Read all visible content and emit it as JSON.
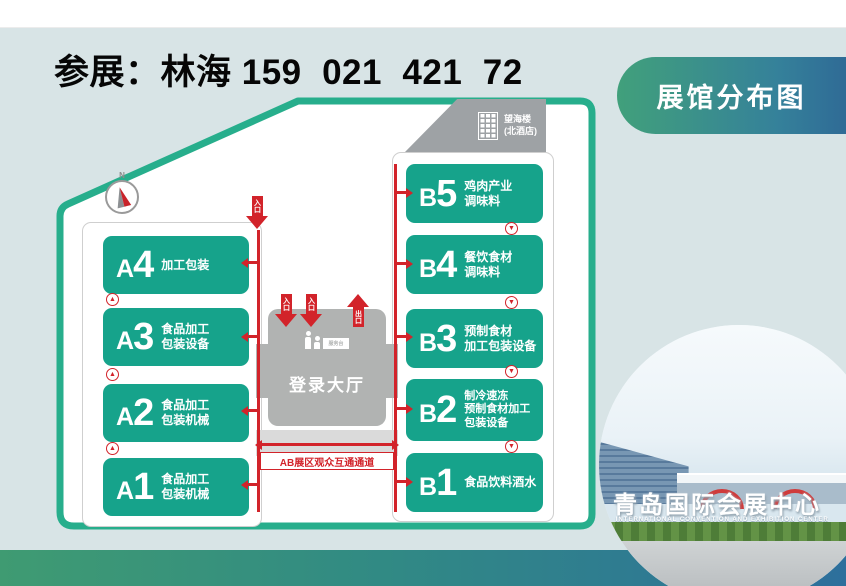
{
  "page": {
    "title": "参展：林海 159  021  421  72"
  },
  "banner": {
    "label": "展馆分布图"
  },
  "colors": {
    "background": "#d8e4e6",
    "hall_green": "#16a38b",
    "map_border_green": "#27ae8c",
    "accent_red": "#d2232a",
    "banner_gradient_left": "#41a07b",
    "banner_gradient_right": "#2f6b96",
    "bottom_bar_left": "#3f9b72",
    "bottom_bar_right": "#2d6f9c"
  },
  "map": {
    "hotel_label": {
      "line1": "望海楼",
      "line2": "(北酒店)"
    },
    "compass_n": "N",
    "halls_a": [
      {
        "id": "A4",
        "lines": [
          "加工包装"
        ]
      },
      {
        "id": "A3",
        "lines": [
          "食品加工",
          "包装设备"
        ]
      },
      {
        "id": "A2",
        "lines": [
          "食品加工",
          "包装机械"
        ]
      },
      {
        "id": "A1",
        "lines": [
          "食品加工",
          "包装机械"
        ]
      }
    ],
    "halls_b": [
      {
        "id": "B5",
        "lines": [
          "鸡肉产业",
          "调味料"
        ]
      },
      {
        "id": "B4",
        "lines": [
          "餐饮食材",
          "调味料"
        ]
      },
      {
        "id": "B3",
        "lines": [
          "预制食材",
          "加工包装设备"
        ]
      },
      {
        "id": "B2",
        "lines": [
          "制冷速冻",
          "预制食材加工",
          "包装设备"
        ]
      },
      {
        "id": "B1",
        "lines": [
          "食品饮料酒水"
        ]
      }
    ],
    "login_hall": {
      "label": "登录大厅",
      "service_desk_label": "服务台"
    },
    "labels": {
      "entrance": "入口",
      "exit": "出口"
    },
    "corridor_label": "AB展区观众互通通道"
  },
  "photo": {
    "monument_text": "青岛国际会展中心",
    "caption_en": "INTERNATIONAL CONVENTION AND EXHIBITION CENTER"
  }
}
